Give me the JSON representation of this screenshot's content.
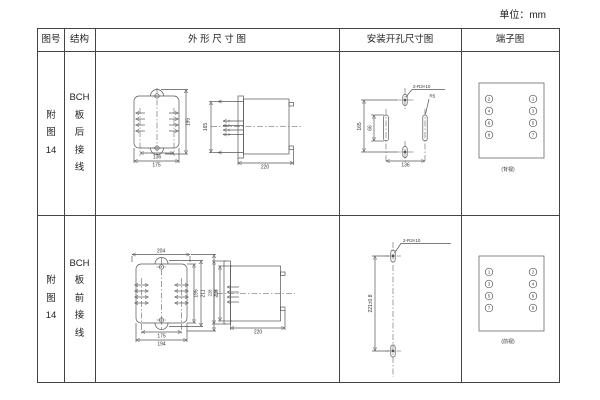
{
  "unit_label": "单位：mm",
  "table": {
    "headers": {
      "fig_no": "图号",
      "structure": "结构",
      "outline": "外 形 尺 寸 图",
      "install": "安装开孔尺寸图",
      "terminal": "端子图"
    }
  },
  "rows": [
    {
      "fig_no": "附\n图\n14",
      "structure": "BCH\n板\n后\n接\n线",
      "outline": {
        "front_inner_width": "136",
        "front_outer_width": "175",
        "front_height": "195",
        "side_height": "165",
        "side_depth": "220"
      },
      "install": {
        "hole_note": "2-R3×10",
        "slot_radius": "R5",
        "vertical_spacing": "165",
        "slot_length": "66",
        "horizontal_spacing": "136"
      },
      "terminal": {
        "left": [
          "2",
          "4",
          "6",
          "8"
        ],
        "right": [
          "1",
          "3",
          "5",
          "7"
        ],
        "caption": "(背视)"
      }
    },
    {
      "fig_no": "附\n图\n14",
      "structure": "BCH\n板\n前\n接\n线",
      "outline": {
        "front_top_width": "204",
        "front_inner_width": "175",
        "front_outer_width": "194",
        "front_height_1": "195",
        "front_height_2": "211",
        "front_height_3": "228",
        "side_height_outer": "228",
        "side_height_inner": "211",
        "side_depth": "220"
      },
      "install": {
        "hole_note": "2-R3×10",
        "vertical_spacing": "221±0.8"
      },
      "terminal": {
        "left": [
          "1",
          "3",
          "5",
          "7"
        ],
        "right": [
          "2",
          "4",
          "6",
          "8"
        ],
        "caption": "(前视)"
      }
    }
  ]
}
